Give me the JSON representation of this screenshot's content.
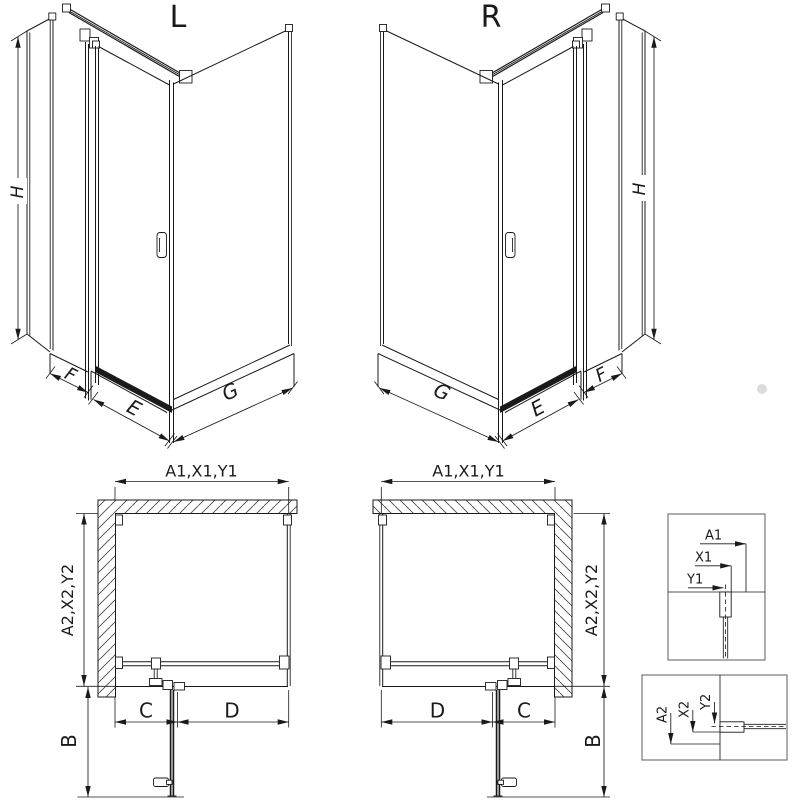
{
  "views": {
    "iso_left": {
      "title": "L",
      "height": "H",
      "panel": "F",
      "door_sill": "E",
      "side": "G"
    },
    "iso_right": {
      "title": "R",
      "height": "H",
      "panel": "F",
      "door_sill": "E",
      "side": "G"
    },
    "plan_left": {
      "width_dim": "A1,X1,Y1",
      "depth_dim": "A2,X2,Y2",
      "door_dim": "C",
      "fixed_dim": "D",
      "swing_dim": "B"
    },
    "plan_right": {
      "width_dim": "A1,X1,Y1",
      "depth_dim": "A2,X2,Y2",
      "door_dim": "C",
      "fixed_dim": "D",
      "swing_dim": "B"
    },
    "detail_width_refs": {
      "outer": "A1",
      "middle": "X1",
      "center": "Y1"
    },
    "detail_depth_refs": {
      "outer": "A2",
      "middle": "X2",
      "center": "Y2"
    }
  },
  "colors": {
    "line": "#1a1a1a",
    "hatch": "#4a4a4a",
    "box": "#6a6a6a",
    "background": "#ffffff",
    "watermark": "#dcdcdc"
  }
}
